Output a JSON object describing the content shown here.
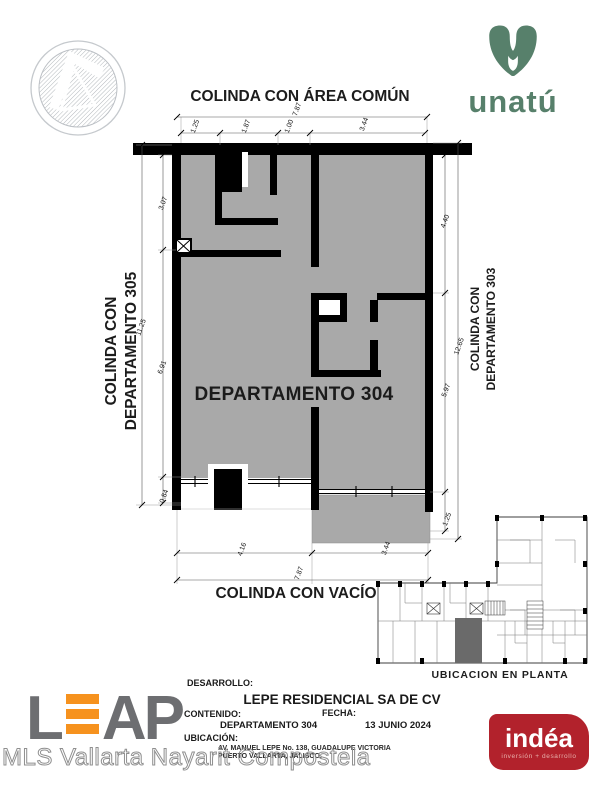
{
  "brand": {
    "unatu_text": "unatú",
    "leap_first": "L",
    "leap_rest": "AP",
    "indea_name": "indéa",
    "indea_tagline": "inversión + desarrollo"
  },
  "plan": {
    "room_label": "DEPARTAMENTO 304",
    "adjacency": {
      "top": "COLINDA CON ÁREA COMÚN",
      "left_line1": "COLINDA CON",
      "left_line2": "DEPARTAMENTO 305",
      "right_line1": "COLINDA CON",
      "right_line2": "DEPARTAMENTO 303",
      "bottom": "COLINDA CON VACÍO"
    },
    "dimensions": {
      "top_overall": "7.87",
      "top_chain": [
        "1.25",
        "1.87",
        "1.00",
        "3.44"
      ],
      "left_outer": "11.25",
      "left_chain": [
        "3.07",
        "6.91",
        "0.84"
      ],
      "right_outer": "12.65",
      "right_chain": [
        "4.40",
        "5.97",
        "1.25"
      ],
      "bottom_overall": "7.87",
      "bottom_chain": [
        "4.16",
        "3.44"
      ]
    }
  },
  "key_plan": {
    "caption": "UBICACION EN PLANTA"
  },
  "title_block": {
    "desarrollo_label": "DESARROLLO:",
    "desarrollo_value": "LEPE RESIDENCIAL SA DE CV",
    "contenido_label": "CONTENIDO:",
    "contenido_value": "DEPARTAMENTO 304",
    "fecha_label": "FECHA:",
    "fecha_value": "13 JUNIO 2024",
    "ubicacion_label": "UBICACIÓN:",
    "ubicacion_line1": "AV. MANUEL LEPE No. 138, GUADALUPE VICTORIA",
    "ubicacion_line2": "PUERTO VALLARTA, JALISCO."
  },
  "watermark": "MLS Vallarta Nayarit Compostela",
  "colors": {
    "plan_gray": "#a9a9a9",
    "wall_black": "#000000",
    "unatu_green": "#57806b",
    "leap_gray": "#6d6e71",
    "leap_orange": "#f6921e",
    "indea_red": "#b2222c"
  }
}
